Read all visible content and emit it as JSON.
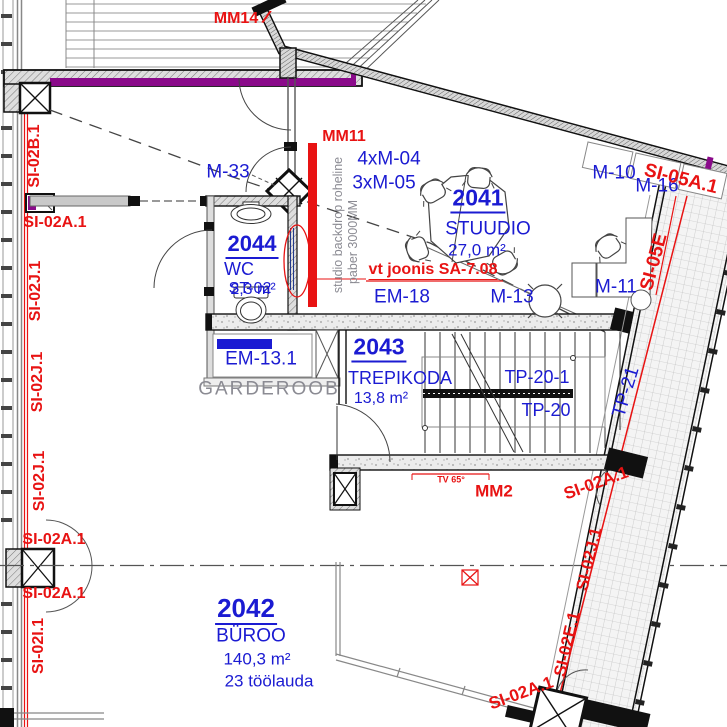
{
  "colors": {
    "blue": "#1b1bd2",
    "red": "#e81313",
    "gray": "#8b8b93",
    "purple": "#8a0a8a"
  },
  "rooms": {
    "studio": {
      "number": "2041",
      "name": "STUUDIO",
      "area": "27,0 m²"
    },
    "office": {
      "number": "2042",
      "name": "BÜROO",
      "area": "140,3 m²",
      "note": "23 töölauda"
    },
    "stairwell": {
      "number": "2043",
      "name": "TREPIKODA",
      "area": "13,8 m²"
    },
    "wc": {
      "number": "2044",
      "name": "WC",
      "area": "2,3 m²",
      "overlap": "ST-02"
    }
  },
  "equipment": {
    "m33": "M-33",
    "m10": "M-10",
    "m16": "M-16",
    "m11": "M-11",
    "m13": "M-13",
    "em18": "EM-18",
    "em131": "EM-13.1",
    "m04_count": "4xM-04",
    "m05_count": "3xM-05",
    "tp20": "TP-20",
    "tp20_1": "TP-20-1",
    "tp21": "TP-21"
  },
  "annotations": {
    "mm14": "MM14",
    "mm14_tail": "/",
    "mm11": "MM11",
    "mm2": "MM2",
    "tv": "TV 65°",
    "see_drawing": "vt joonis SA-7.08",
    "backdrop_line1": "studio backdrop roheline",
    "backdrop_line2": "paber 3000MM",
    "garderoob": "GARDEROOB"
  },
  "section_marks": {
    "si02b1": "SI-02B.1",
    "si02a1": "SI-02A.1",
    "si02j1": "SI-02J.1",
    "si02i1": "SI-02I.1",
    "si02e1": "SI-02E.1",
    "si05a1": "SI-05A.1",
    "si05e": "SI-05E"
  }
}
